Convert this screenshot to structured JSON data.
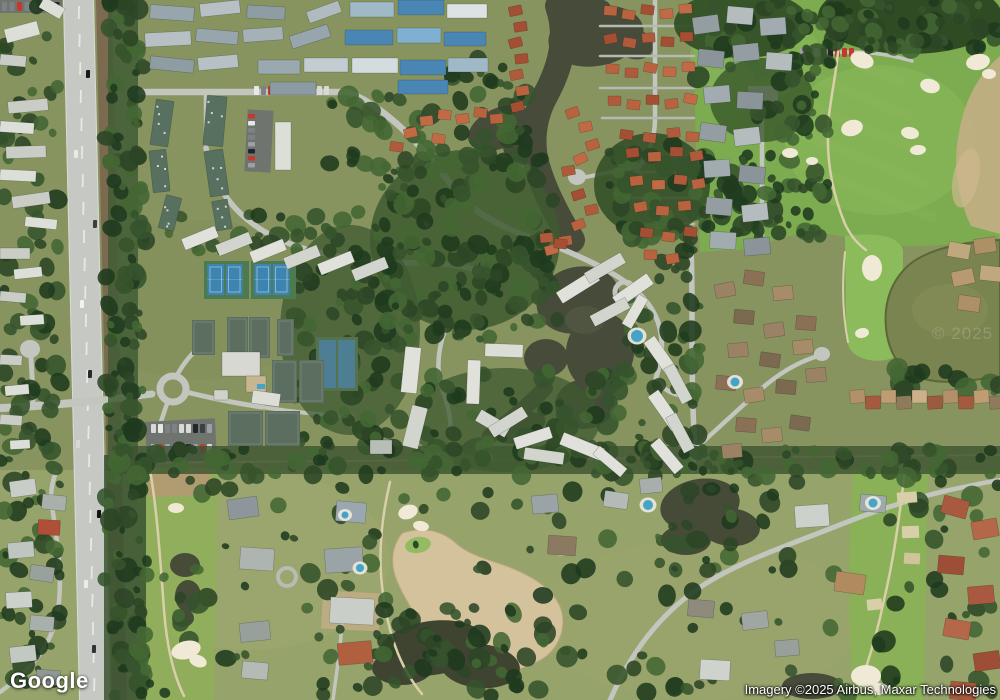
{
  "branding": {
    "logo_text": "Google"
  },
  "attribution": {
    "imagery_credit": "Imagery ©2025 Airbus, Maxar Technologies",
    "watermark": "© 2025"
  },
  "colors": {
    "base_grass": "#87945f",
    "grass_south": "#96a36a",
    "golf_green": "#7dab50",
    "golf_light": "#8cbb5c",
    "water_dark": "#474c3a",
    "water_murky": "#7a8450",
    "pond_shadow": "#3f4431",
    "sand": "#d3c29b",
    "bunker_sand": "#efe9d6",
    "dirt": "#b59a74",
    "road": "#c2c6bf",
    "asphalt_dark": "#6f756e",
    "median_dirt": "#7b6a50",
    "cart_path": "#d9cfa9",
    "tree_dark": "#1f3a1e",
    "tree_mid": "#2c4526",
    "tree_olive": "#35532c",
    "tree_bright": "#436733",
    "roof_white": "#dfe1da",
    "roof_white_dim": "#d2d5cd",
    "roof_gray": "#97a5ad",
    "roof_blue": "#4a86b4",
    "roof_blue_light": "#7fb0d2",
    "roof_teal_green": "#57705f",
    "roof_terracotta": "#b05a3c",
    "roof_brown": "#9b8264",
    "court_blue": "#3d85b0",
    "court_teal": "#4e7e93",
    "court_clay_green": "#5c6e60",
    "pool_blue": "#45a3c8"
  }
}
